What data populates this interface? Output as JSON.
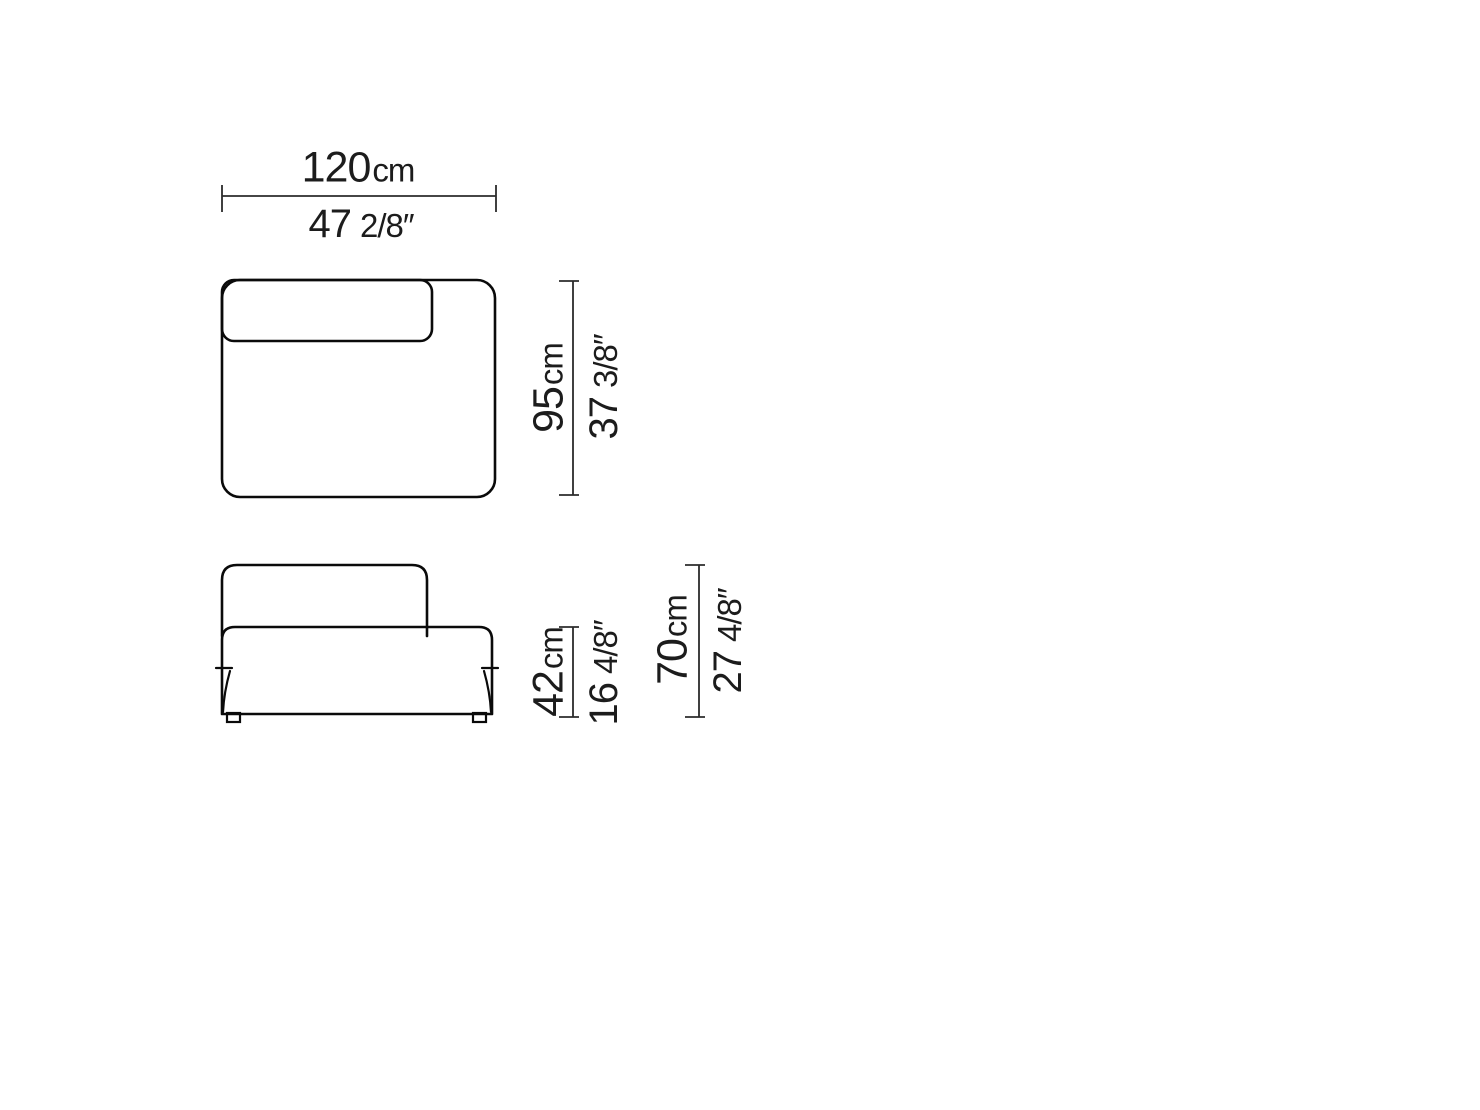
{
  "colors": {
    "background": "#ffffff",
    "outline": "#0a0a0a",
    "fill": "#ebebeb",
    "dimension_line": "#2b2b2b",
    "text": "#1c1c1c",
    "foot_fill": "#ffffff"
  },
  "dimensions": {
    "width": {
      "metric_value": "120",
      "metric_unit": "cm",
      "imperial_value": "47",
      "imperial_fraction": "2/8″"
    },
    "depth": {
      "metric_value": "95",
      "metric_unit": "cm",
      "imperial_value": "37",
      "imperial_fraction": "3/8″"
    },
    "seat_height": {
      "metric_value": "42",
      "metric_unit": "cm",
      "imperial_value": "16",
      "imperial_fraction": "4/8″"
    },
    "overall_height": {
      "metric_value": "70",
      "metric_unit": "cm",
      "imperial_value": "27",
      "imperial_fraction": "4/8″"
    }
  }
}
